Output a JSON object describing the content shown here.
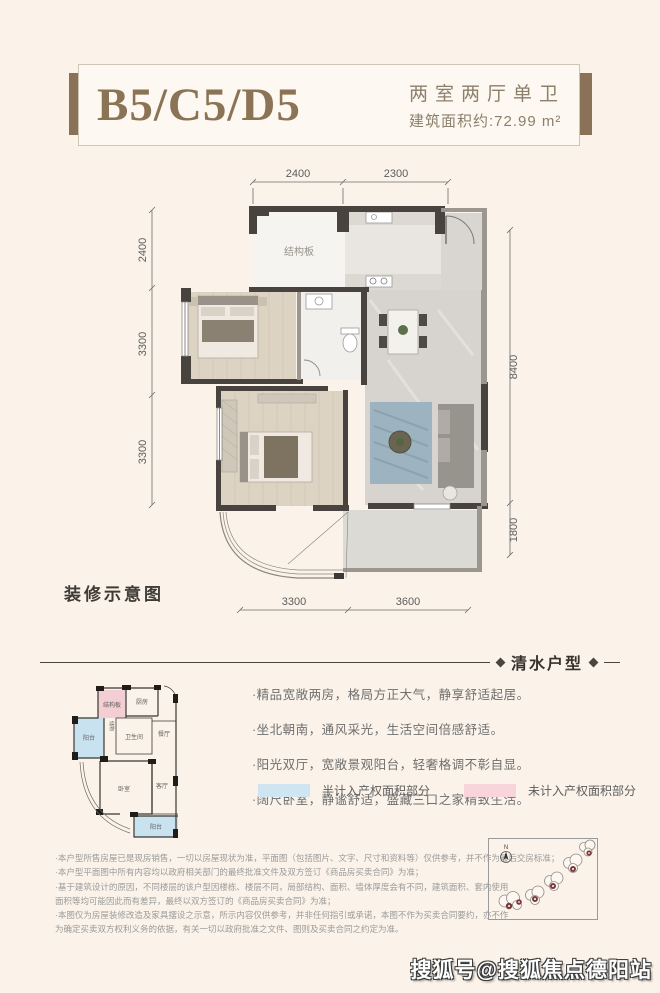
{
  "header": {
    "unit_code": "B5/C5/D5",
    "layout_type": "两室两厅单卫",
    "area_text": "建筑面积约:72.99 m²",
    "accent_color": "#8a7258"
  },
  "floorplan": {
    "caption": "装修示意图",
    "structural_label": "结构板",
    "dimensions": {
      "top": [
        "2400",
        "2300"
      ],
      "left": [
        "2400",
        "3300",
        "3300"
      ],
      "right": [
        "8400",
        "1800"
      ],
      "bottom": [
        "3300",
        "3600"
      ]
    }
  },
  "section_divider": {
    "title": "清水户型"
  },
  "thumbnail_plan": {
    "structural": "结构板",
    "kitchen": "厨房",
    "storage": "储物",
    "bathroom": "卫生间",
    "dining": "餐厅",
    "balcony_left": "阳台",
    "bedroom": "卧室",
    "living": "客厅",
    "balcony_bottom": "阳台"
  },
  "features": [
    "·精品宽敞两房，格局方正大气，静享舒适起居。",
    "·坐北朝南，通风采光，生活空间倍感舒适。",
    "·阳光双厅，宽敞景观阳台，轻奢格调不彰自显。",
    "·阔尺卧室，静谧舒适，盛藏三口之家精致生活。"
  ],
  "legend": {
    "half_counted": {
      "label": "半计入产权面积部分",
      "color": "#cfe5f1"
    },
    "not_counted": {
      "label": "未计入产权面积部分",
      "color": "#f7d5da"
    }
  },
  "disclaimer": [
    "·本户型所售房屋已是现房销售，一切以房屋现状为准，平面图（包括图片、文字、尺寸和资料等）仅供参考，并不作为最后交房标准；",
    "·本户型平面图中所有内容均以政府相关部门的最终批准文件及双方签订《商品房买卖合同》为准；",
    "·基于建筑设计的原因，不同楼层的该户型因楼栋、楼层不同，局部结构、面积、墙体厚度会有不同，建筑面积、套内使用",
    "面积等均可能因此而有差异，最终以双方签订的《商品房买卖合同》为准；",
    "·本图仅为房屋装修改造及家具摆设之示意，所示内容仅供参考，并非任何指引或承诺，本图不作为买卖合同要约，亦不作",
    "为确定买卖双方权利义务的依据，有关一切以政府批准之文件、图则及买卖合同之约定为准。"
  ],
  "map": {
    "compass_label": "N"
  },
  "watermark": "搜狐号@搜狐焦点德阳站"
}
